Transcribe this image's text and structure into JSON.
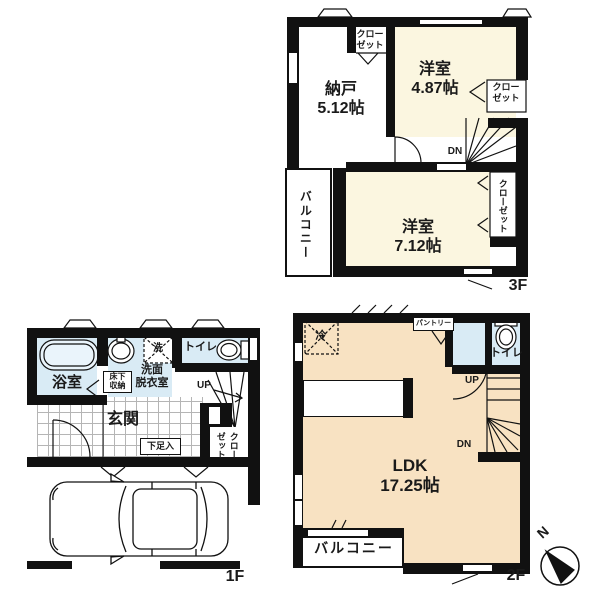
{
  "colors": {
    "wall": "#111111",
    "room_cream": "#fbf6e0",
    "room_peach": "#f8e2c2",
    "room_blue": "#d9ebf5"
  },
  "f3": {
    "floor_label": "3F",
    "nando_name": "納戸",
    "nando_size": "5.12帖",
    "room1_name": "洋室",
    "room1_size": "4.87帖",
    "room2_name": "洋室",
    "room2_size": "7.12帖",
    "closet_top_line1": "クロー",
    "closet_top_line2": "ゼット",
    "closet_right_line1": "クロー",
    "closet_right_line2": "ゼット",
    "closet_vertical": "クローゼット",
    "balcony": "バルコニー",
    "dn": "DN"
  },
  "f1": {
    "floor_label": "1F",
    "bath": "浴室",
    "washroom_line1": "洗面",
    "washroom_line2": "脱衣室",
    "underfloor_line1": "床下",
    "underfloor_line2": "収納",
    "laundry": "洗",
    "toilet": "トイレ",
    "up": "UP",
    "entrance": "玄関",
    "shoe_box": "下足入",
    "closet_col_right": "クロー",
    "closet_col_left": "ゼット"
  },
  "f2": {
    "floor_label": "2F",
    "ldk_name": "LDK",
    "ldk_size": "17.25帖",
    "fridge": "冷",
    "pantry": "パントリー",
    "toilet": "トイレ",
    "up": "UP",
    "dn": "DN",
    "balcony": "バルコニー"
  },
  "compass": {
    "north": "N"
  }
}
